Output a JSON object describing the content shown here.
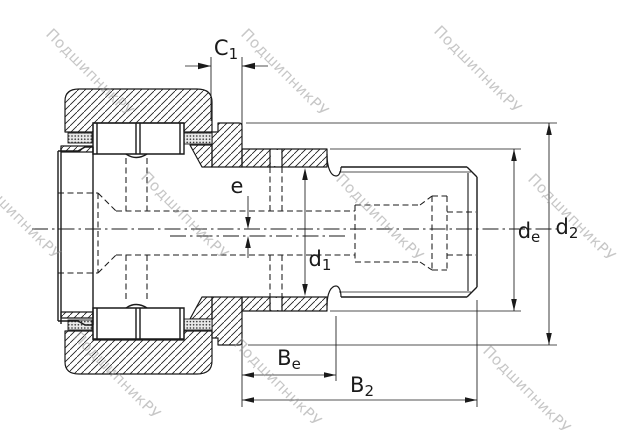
{
  "watermark": {
    "text": "ПодшипникРУ",
    "color": "#9a9a9a"
  },
  "drawing": {
    "background": "#ffffff",
    "line_color": "#1a1a1a",
    "dimension_labels": {
      "c1": {
        "main": "C",
        "sub": "1"
      },
      "e": {
        "main": "e",
        "sub": ""
      },
      "d1": {
        "main": "d",
        "sub": "1"
      },
      "de": {
        "main": "d",
        "sub": "e"
      },
      "d2": {
        "main": "d",
        "sub": "2"
      },
      "be": {
        "main": "B",
        "sub": "e"
      },
      "b2": {
        "main": "B",
        "sub": "2"
      }
    }
  }
}
